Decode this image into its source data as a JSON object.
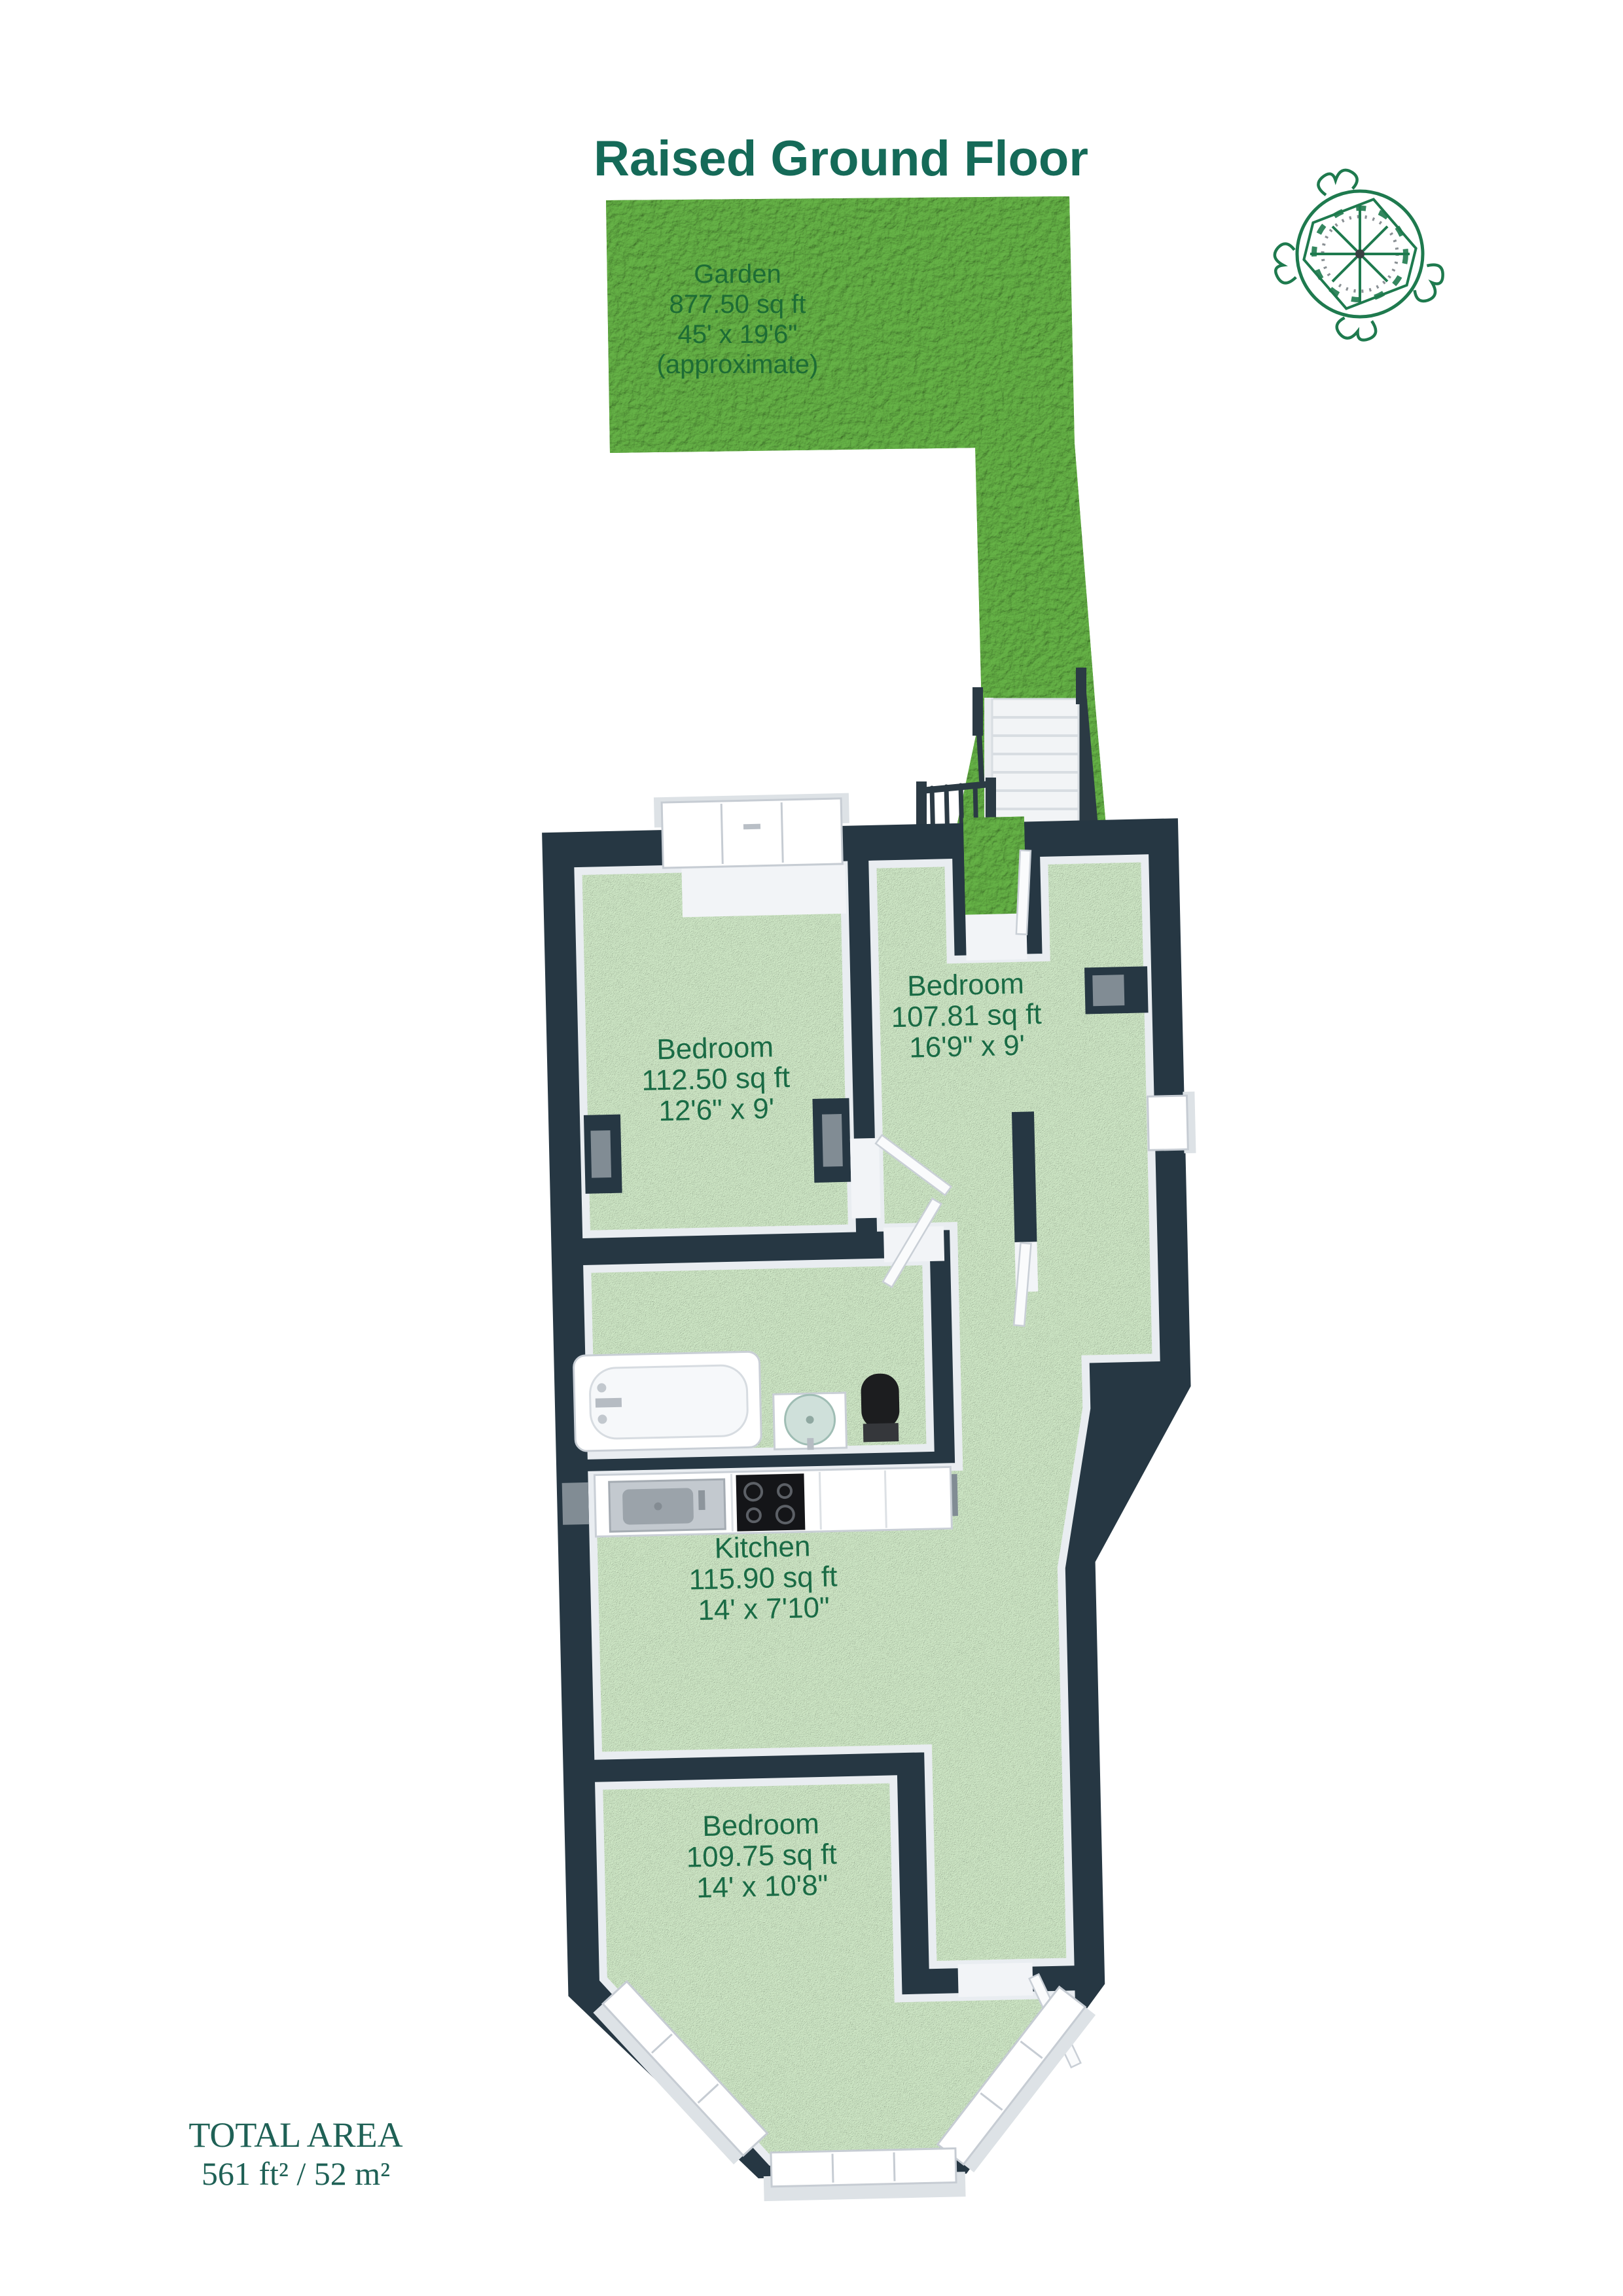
{
  "title": "Raised Ground Floor",
  "garden": {
    "name": "Garden",
    "area": "877.50 sq ft",
    "dimensions": "45' x 19'6\"",
    "note": "(approximate)"
  },
  "rooms": [
    {
      "id": "bedroom-1",
      "name": "Bedroom",
      "area": "112.50 sq ft",
      "dimensions": "12'6\" x 9'"
    },
    {
      "id": "bedroom-2",
      "name": "Bedroom",
      "area": "107.81 sq ft",
      "dimensions": "16'9\" x 9'"
    },
    {
      "id": "kitchen",
      "name": "Kitchen",
      "area": "115.90 sq ft",
      "dimensions": "14' x 7'10\""
    },
    {
      "id": "bedroom-3",
      "name": "Bedroom",
      "area": "109.75 sq ft",
      "dimensions": "14' x 10'8\""
    }
  ],
  "total_area": {
    "label": "TOTAL AREA",
    "value": "561 ft² / 52 m²"
  },
  "icons": {
    "compass": "compass-rose"
  },
  "colors": {
    "title_text": "#156a58",
    "room_label_text": "#1a6b45",
    "garden_text": "#1d6c35",
    "total_text": "#1f6156",
    "wall": "#263743",
    "floor": "#b9d9b3",
    "garden_grass": "#57a13b",
    "fixture_white": "#ffffff",
    "toilet_black": "#1c1d1f",
    "hob_black": "#141518",
    "compass_green": "#1e7a4e"
  }
}
